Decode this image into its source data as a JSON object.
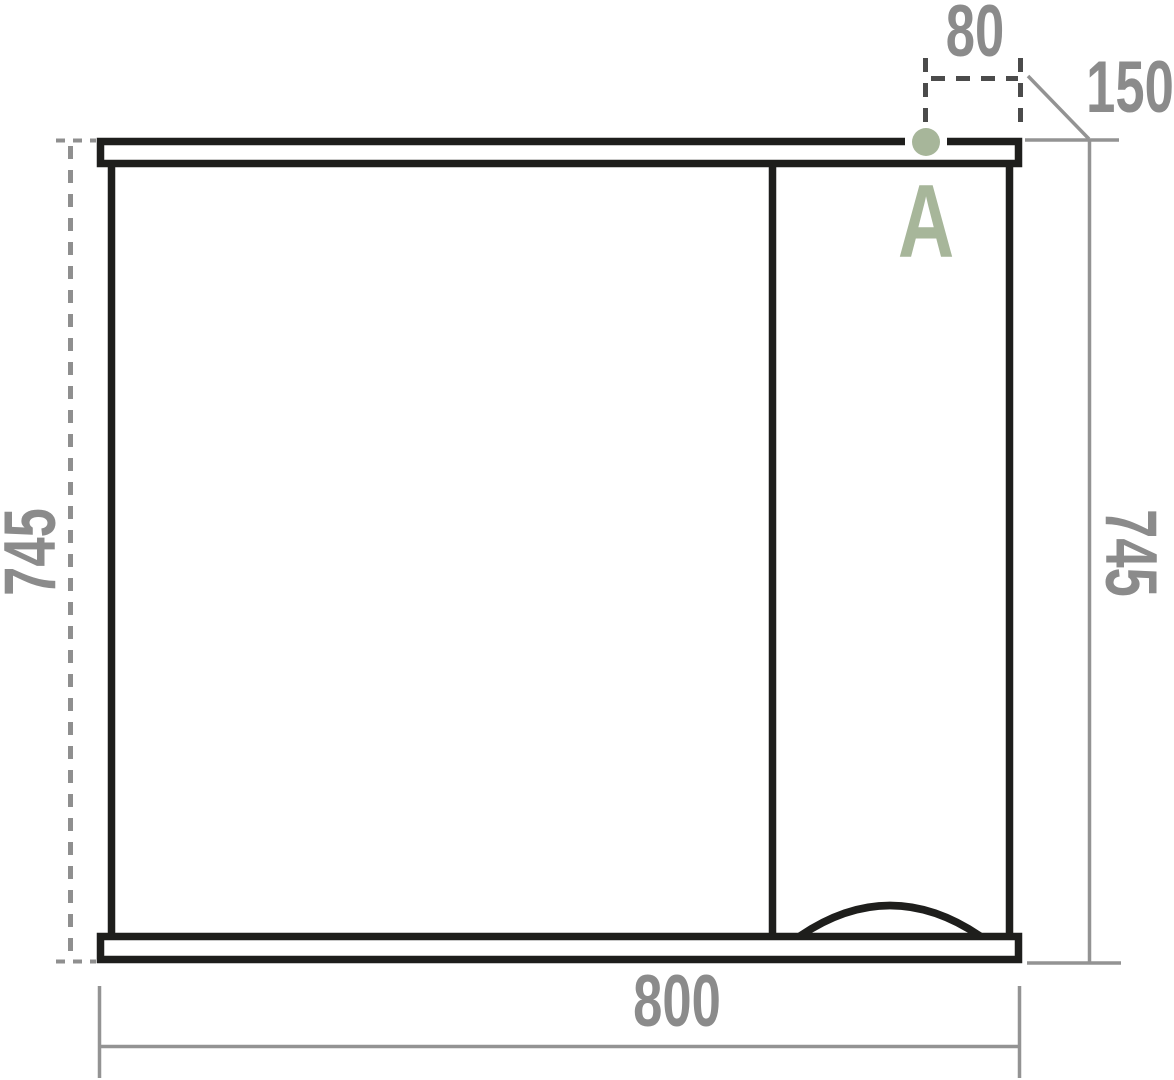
{
  "diagram": {
    "type": "technical-drawing",
    "subject": "mirror-cabinet front elevation with dimensions",
    "dimensions": {
      "top_offset": "80",
      "side_section_width": "150",
      "height_left": "745",
      "height_right": "745",
      "overall_width": "800"
    },
    "annotations": {
      "point_label": "A"
    },
    "colors": {
      "outline_black": "#1e1e1c",
      "dimension_gray": "#939393",
      "dimension_text_gray": "#8b8b8b",
      "detail_dash_dark": "#4b4b4b",
      "accent_green": "#a7b69a",
      "background": "#ffffff"
    }
  }
}
